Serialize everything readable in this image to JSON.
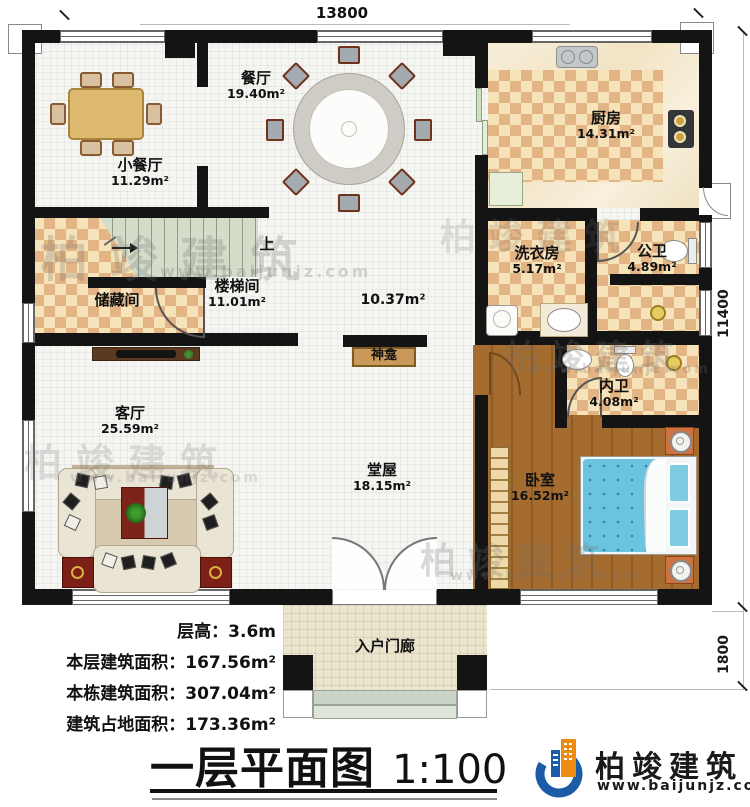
{
  "dimensions": {
    "top": "13800",
    "right": "11400",
    "porch": "1800"
  },
  "rooms": {
    "dining_small": {
      "name": "小餐厅",
      "area": "11.29m²"
    },
    "dining": {
      "name": "餐厅",
      "area": "19.40m²"
    },
    "kitchen": {
      "name": "厨房",
      "area": "14.31m²"
    },
    "laundry": {
      "name": "洗衣房",
      "area": "5.17m²"
    },
    "public_bath": {
      "name": "公卫",
      "area": "4.89m²"
    },
    "inner_bath": {
      "name": "内卫",
      "area": "4.08m²"
    },
    "storage": {
      "name": "储藏间",
      "area": ""
    },
    "stairwell": {
      "name": "楼梯间",
      "area": "11.01m²"
    },
    "hallway": {
      "name": "",
      "area": "10.37m²"
    },
    "living": {
      "name": "客厅",
      "area": "25.59m²"
    },
    "hall": {
      "name": "堂屋",
      "area": "18.15m²"
    },
    "bedroom": {
      "name": "卧室",
      "area": "16.52m²"
    },
    "porch": {
      "name": "入户门廊",
      "area": ""
    }
  },
  "annotations": {
    "stairs_up": "上",
    "shrine": "神龛"
  },
  "info": {
    "line1": "层高：3.6m",
    "line2": "本层建筑面积：167.56m²",
    "line3": "本栋建筑面积：307.04m²",
    "line4": "建筑占地面积：173.36m²"
  },
  "title": {
    "name": "一层平面图",
    "scale": "1:100"
  },
  "brand": {
    "name": "柏竣建筑",
    "website": "www.baijunjz.com"
  },
  "colors": {
    "wall": "#141414",
    "checker_dark": "#e3b484",
    "checker_light": "#f6e3ba",
    "wood": "#a56c2f",
    "bed_blue": "#66c3e0",
    "brand_blue": "#1c5ba6",
    "brand_orange": "#ec8c10"
  }
}
